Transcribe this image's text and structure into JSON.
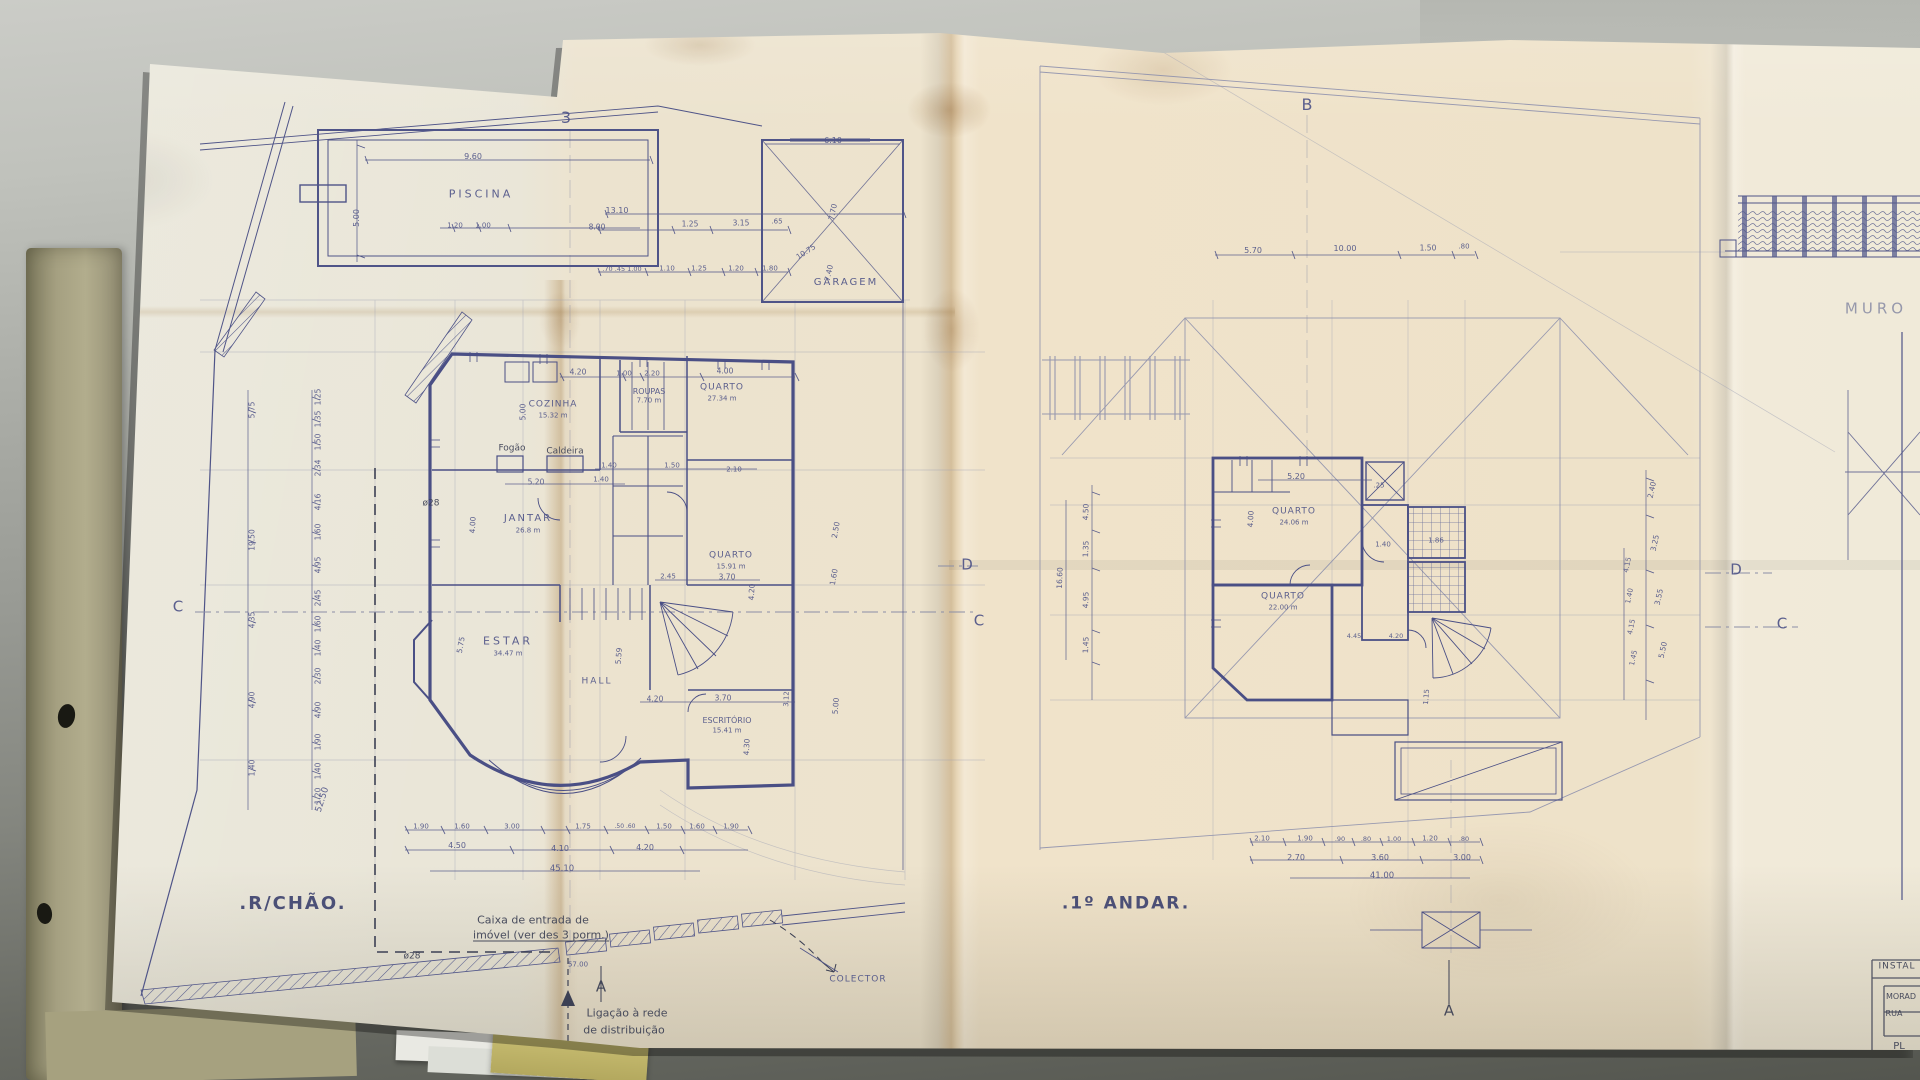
{
  "colors": {
    "ink": "#4f5488",
    "ink-strong": "#3d4273",
    "pencil": "#8f92a8",
    "dark": "#3c4054",
    "title-ink": "#3f4470",
    "paper": "#ece4d1",
    "desk-light": "#c8c9c4",
    "desk-dark": "#565851",
    "folder-olive": "#a7a281",
    "folder-yellow": "#c8bd72"
  },
  "document": {
    "plans": [
      {
        "title": ".R/CHÃO.",
        "rooms": [
          "PISCINA",
          "GARAGEM",
          "COZINHA",
          "ROUPAS",
          "QUARTO",
          "JANTAR",
          "QUARTO",
          "ESTAR",
          "HALL",
          "ESCRITÓRIO"
        ],
        "areas": [
          "15.32 m",
          "7.70 m",
          "27.34 m",
          "26.8 m",
          "15.91 m",
          "34.47 m",
          "15.41 m"
        ]
      },
      {
        "title": ".1º ANDAR.",
        "rooms": [
          "QUARTO",
          "QUARTO"
        ],
        "areas": [
          "24.06 m",
          "22.00 m"
        ]
      }
    ],
    "section_markers": [
      "3",
      "B",
      "C",
      "D",
      "A"
    ],
    "titleblock": [
      "INSTAL",
      "MORAD",
      "RUA",
      "PL"
    ]
  },
  "labels": {
    "markers": [
      {
        "n": "section-marker-3",
        "t": "3",
        "x": 566,
        "y": 118,
        "fs": 16,
        "c": "ink"
      },
      {
        "n": "section-marker-b",
        "t": "B",
        "x": 1307,
        "y": 105,
        "fs": 16,
        "c": "ink"
      },
      {
        "n": "section-marker-c-left",
        "t": "C",
        "x": 178,
        "y": 607,
        "fs": 15,
        "c": "ink"
      },
      {
        "n": "section-marker-d-mid",
        "t": "D",
        "x": 967,
        "y": 565,
        "fs": 15,
        "c": "ink"
      },
      {
        "n": "section-marker-c-mid",
        "t": "C",
        "x": 979,
        "y": 621,
        "fs": 15,
        "c": "ink"
      },
      {
        "n": "section-marker-d-right",
        "t": "D",
        "x": 1736,
        "y": 570,
        "fs": 15,
        "c": "ink"
      },
      {
        "n": "section-marker-c-right",
        "t": "C",
        "x": 1782,
        "y": 624,
        "fs": 15,
        "c": "ink"
      },
      {
        "n": "section-marker-a-left",
        "t": "A",
        "x": 601,
        "y": 987,
        "fs": 15,
        "c": "dark"
      },
      {
        "n": "section-marker-a-right",
        "t": "A",
        "x": 1449,
        "y": 1011,
        "fs": 15,
        "c": "dark"
      },
      {
        "n": "muro-label",
        "t": "MURO",
        "x": 1876,
        "y": 309,
        "fs": 15,
        "c": "pencil",
        "ls": 4
      }
    ],
    "ground_rooms": [
      {
        "n": "plan-title-ground",
        "t": ".R/CHÃO.",
        "x": 293,
        "y": 904,
        "fs": 18,
        "c": "title",
        "ls": 2
      },
      {
        "n": "room-piscina",
        "t": "PISCINA",
        "x": 481,
        "y": 194,
        "fs": 11,
        "c": "ink",
        "ls": 3
      },
      {
        "n": "room-garagem",
        "t": "GARAGEM",
        "x": 846,
        "y": 283,
        "fs": 10,
        "c": "ink",
        "ls": 2
      },
      {
        "n": "room-cozinha",
        "t": "COZINHA",
        "x": 553,
        "y": 405,
        "fs": 9,
        "c": "ink",
        "ls": 1
      },
      {
        "n": "room-cozinha-area",
        "t": "15.32 m",
        "x": 553,
        "y": 416,
        "fs": 7,
        "c": "ink"
      },
      {
        "n": "room-roupas",
        "t": "ROUPAS",
        "x": 649,
        "y": 392,
        "fs": 8,
        "c": "ink"
      },
      {
        "n": "room-roupas-area",
        "t": "7.70 m",
        "x": 649,
        "y": 401,
        "fs": 7,
        "c": "ink"
      },
      {
        "n": "room-quarto-1",
        "t": "QUARTO",
        "x": 722,
        "y": 388,
        "fs": 9,
        "c": "ink",
        "ls": 1
      },
      {
        "n": "room-quarto-1-area",
        "t": "27.34 m",
        "x": 722,
        "y": 399,
        "fs": 7,
        "c": "ink"
      },
      {
        "n": "room-jantar",
        "t": "JANTAR",
        "x": 528,
        "y": 519,
        "fs": 10,
        "c": "ink",
        "ls": 2
      },
      {
        "n": "room-jantar-area",
        "t": "26.8 m",
        "x": 528,
        "y": 531,
        "fs": 7,
        "c": "ink"
      },
      {
        "n": "room-quarto-2",
        "t": "QUARTO",
        "x": 731,
        "y": 556,
        "fs": 9,
        "c": "ink",
        "ls": 1
      },
      {
        "n": "room-quarto-2-area",
        "t": "15.91 m",
        "x": 731,
        "y": 567,
        "fs": 7,
        "c": "ink"
      },
      {
        "n": "room-estar",
        "t": "ESTAR",
        "x": 508,
        "y": 641,
        "fs": 11,
        "c": "ink",
        "ls": 3
      },
      {
        "n": "room-estar-area",
        "t": "34.47 m",
        "x": 508,
        "y": 654,
        "fs": 7,
        "c": "ink"
      },
      {
        "n": "room-hall",
        "t": "HALL",
        "x": 597,
        "y": 682,
        "fs": 9,
        "c": "ink",
        "ls": 2
      },
      {
        "n": "room-escritorio",
        "t": "ESCRITÓRIO",
        "x": 727,
        "y": 721,
        "fs": 8,
        "c": "ink"
      },
      {
        "n": "room-escritorio-area",
        "t": "15.41 m",
        "x": 727,
        "y": 731,
        "fs": 7,
        "c": "ink"
      },
      {
        "n": "fogao-label",
        "t": "Fogão",
        "x": 512,
        "y": 449,
        "fs": 9,
        "c": "dark"
      },
      {
        "n": "caldeira-label",
        "t": "Caldeira",
        "x": 565,
        "y": 452,
        "fs": 9,
        "c": "dark"
      },
      {
        "n": "diameter-28-upper",
        "t": "ø28",
        "x": 431,
        "y": 504,
        "fs": 9,
        "c": "dark"
      },
      {
        "n": "diameter-28-lower",
        "t": "ø28",
        "x": 412,
        "y": 957,
        "fs": 9,
        "c": "dark"
      }
    ],
    "ground_annotations": [
      {
        "n": "caixa-note-line1",
        "t": "Caixa de entrada de",
        "x": 533,
        "y": 920,
        "fs": 11,
        "c": "dark"
      },
      {
        "n": "caixa-note-line2",
        "t": "imóvel (ver des 3 porm.)",
        "x": 541,
        "y": 935,
        "fs": 11,
        "c": "dark",
        "u": true
      },
      {
        "n": "ligacao-note-line1",
        "t": "Ligação à rede",
        "x": 627,
        "y": 1013,
        "fs": 11,
        "c": "dark"
      },
      {
        "n": "ligacao-note-line2",
        "t": "de distribuição",
        "x": 624,
        "y": 1030,
        "fs": 11,
        "c": "dark"
      },
      {
        "n": "colector-label",
        "t": "COLECTOR",
        "x": 858,
        "y": 980,
        "fs": 9,
        "c": "ink",
        "ls": 1
      },
      {
        "n": "dim-57-00",
        "t": "57.00",
        "x": 578,
        "y": 965,
        "fs": 7,
        "c": "ink"
      }
    ],
    "ground_dims": [
      {
        "t": "9.60",
        "x": 473,
        "y": 157
      },
      {
        "t": "5.00",
        "x": 357,
        "y": 218,
        "r": -90
      },
      {
        "t": "1.20",
        "x": 455,
        "y": 226,
        "fs": 7
      },
      {
        "t": "1.00",
        "x": 483,
        "y": 226,
        "fs": 7
      },
      {
        "t": "13.10",
        "x": 617,
        "y": 211
      },
      {
        "t": "8.00",
        "x": 597,
        "y": 227,
        "fs": 7.5
      },
      {
        "t": "1.25",
        "x": 690,
        "y": 224,
        "fs": 7.5
      },
      {
        "t": "3.15",
        "x": 741,
        "y": 223,
        "fs": 7.5
      },
      {
        "t": ".65",
        "x": 777,
        "y": 222,
        "fs": 7
      },
      {
        "t": "10.75",
        "x": 806,
        "y": 252,
        "fs": 7.5,
        "r": -33
      },
      {
        "t": "7.70",
        "x": 833,
        "y": 212,
        "fs": 7.5,
        "r": -78
      },
      {
        "t": "7.40",
        "x": 829,
        "y": 273,
        "fs": 7.5,
        "r": -78
      },
      {
        "t": ".70 .45 1.00",
        "x": 622,
        "y": 269,
        "fs": 6.5
      },
      {
        "t": "1.10",
        "x": 667,
        "y": 269,
        "fs": 7
      },
      {
        "t": "1.25",
        "x": 699,
        "y": 269,
        "fs": 7
      },
      {
        "t": "1.20",
        "x": 736,
        "y": 269,
        "fs": 7
      },
      {
        "t": "1.80",
        "x": 770,
        "y": 269,
        "fs": 7
      },
      {
        "t": "6.10",
        "x": 833,
        "y": 141
      },
      {
        "t": "4.20",
        "x": 578,
        "y": 372,
        "fs": 7.5
      },
      {
        "t": "1.00",
        "x": 624,
        "y": 374,
        "fs": 7
      },
      {
        "t": "2.20",
        "x": 652,
        "y": 374,
        "fs": 7
      },
      {
        "t": "4.00",
        "x": 725,
        "y": 371,
        "fs": 7.5
      },
      {
        "t": "5.00",
        "x": 523,
        "y": 412,
        "fs": 7.5,
        "r": -90
      },
      {
        "t": "1.40",
        "x": 609,
        "y": 466,
        "fs": 7
      },
      {
        "t": "1.50",
        "x": 672,
        "y": 466,
        "fs": 7
      },
      {
        "t": "2.10",
        "x": 734,
        "y": 470,
        "fs": 7
      },
      {
        "t": "5.20",
        "x": 536,
        "y": 482,
        "fs": 7.5
      },
      {
        "t": "1.40",
        "x": 601,
        "y": 480,
        "fs": 7
      },
      {
        "t": "4.00",
        "x": 473,
        "y": 525,
        "fs": 7.5,
        "r": -87
      },
      {
        "t": "2.45",
        "x": 668,
        "y": 577,
        "fs": 7
      },
      {
        "t": "3.70",
        "x": 727,
        "y": 577,
        "fs": 7.5
      },
      {
        "t": "4.20",
        "x": 752,
        "y": 592,
        "fs": 7.5,
        "r": -87
      },
      {
        "t": "2.50",
        "x": 836,
        "y": 530,
        "fs": 7.5,
        "r": -80
      },
      {
        "t": "1.60",
        "x": 834,
        "y": 577,
        "fs": 7.5,
        "r": -80
      },
      {
        "t": "5.75",
        "x": 461,
        "y": 645,
        "fs": 7.5,
        "r": -80
      },
      {
        "t": "5.59",
        "x": 619,
        "y": 656,
        "fs": 7.5,
        "r": -85
      },
      {
        "t": "4.20",
        "x": 655,
        "y": 699,
        "fs": 7.5
      },
      {
        "t": "3.70",
        "x": 723,
        "y": 698,
        "fs": 7.5
      },
      {
        "t": "4.30",
        "x": 747,
        "y": 747,
        "fs": 7.5,
        "r": -87
      },
      {
        "t": "3.12",
        "x": 787,
        "y": 699,
        "fs": 7,
        "r": -87
      },
      {
        "t": "5.00",
        "x": 836,
        "y": 706,
        "fs": 7.5,
        "r": -85
      },
      {
        "t": "1.25",
        "x": 318,
        "y": 397,
        "fs": 7.5,
        "r": -90
      },
      {
        "t": "1.35",
        "x": 318,
        "y": 419,
        "fs": 7.5,
        "r": -90
      },
      {
        "t": "1.50",
        "x": 318,
        "y": 442,
        "fs": 7.5,
        "r": -90
      },
      {
        "t": "2.34",
        "x": 318,
        "y": 468,
        "fs": 7.5,
        "r": -90
      },
      {
        "t": "4.16",
        "x": 318,
        "y": 502,
        "fs": 7.5,
        "r": -90
      },
      {
        "t": "1.60",
        "x": 318,
        "y": 532,
        "fs": 7.5,
        "r": -90
      },
      {
        "t": "4.95",
        "x": 318,
        "y": 565,
        "fs": 7.5,
        "r": -90
      },
      {
        "t": "2.45",
        "x": 318,
        "y": 598,
        "fs": 7.5,
        "r": -90
      },
      {
        "t": "1.60",
        "x": 318,
        "y": 624,
        "fs": 7.5,
        "r": -90
      },
      {
        "t": "1.40",
        "x": 318,
        "y": 648,
        "fs": 7.5,
        "r": -90
      },
      {
        "t": "2.30",
        "x": 318,
        "y": 676,
        "fs": 7.5,
        "r": -90
      },
      {
        "t": "4.90",
        "x": 318,
        "y": 710,
        "fs": 7.5,
        "r": -90
      },
      {
        "t": "1.90",
        "x": 318,
        "y": 742,
        "fs": 7.5,
        "r": -90
      },
      {
        "t": "1.40",
        "x": 318,
        "y": 771,
        "fs": 7.5,
        "r": -90
      },
      {
        "t": "1.20",
        "x": 318,
        "y": 796,
        "fs": 7.5,
        "r": -90
      },
      {
        "t": "5.75",
        "x": 252,
        "y": 410,
        "fs": 7.5,
        "r": -90
      },
      {
        "t": "19.50",
        "x": 252,
        "y": 540,
        "fs": 7.5,
        "r": -90
      },
      {
        "t": "4.35",
        "x": 252,
        "y": 620,
        "fs": 7.5,
        "r": -90
      },
      {
        "t": "4.90",
        "x": 252,
        "y": 700,
        "fs": 7.5,
        "r": -90
      },
      {
        "t": "1.40",
        "x": 252,
        "y": 768,
        "fs": 7.5,
        "r": -90
      },
      {
        "t": "52.50",
        "x": 323,
        "y": 800,
        "fs": 9,
        "r": -72
      },
      {
        "t": "1.90",
        "x": 421,
        "y": 827,
        "fs": 7
      },
      {
        "t": "1.60",
        "x": 462,
        "y": 827,
        "fs": 7
      },
      {
        "t": "3.00",
        "x": 512,
        "y": 827,
        "fs": 7
      },
      {
        "t": "1.75",
        "x": 583,
        "y": 827,
        "fs": 7
      },
      {
        "t": ".50 .60",
        "x": 625,
        "y": 827,
        "fs": 6
      },
      {
        "t": "1.50",
        "x": 664,
        "y": 827,
        "fs": 7
      },
      {
        "t": "1.60",
        "x": 697,
        "y": 827,
        "fs": 7
      },
      {
        "t": "1.90",
        "x": 731,
        "y": 827,
        "fs": 7
      },
      {
        "t": "4.50",
        "x": 457,
        "y": 846
      },
      {
        "t": "4.10",
        "x": 560,
        "y": 849
      },
      {
        "t": "4.20",
        "x": 645,
        "y": 848
      },
      {
        "t": "45.10",
        "x": 562,
        "y": 869,
        "fs": 8.5
      }
    ],
    "first_rooms": [
      {
        "n": "plan-title-first",
        "t": ".1º ANDAR.",
        "x": 1126,
        "y": 904,
        "fs": 17,
        "c": "title",
        "ls": 2
      },
      {
        "n": "room-quarto-3",
        "t": "QUARTO",
        "x": 1294,
        "y": 512,
        "fs": 9,
        "c": "ink",
        "ls": 1
      },
      {
        "n": "room-quarto-3-area",
        "t": "24.06 m",
        "x": 1294,
        "y": 523,
        "fs": 7,
        "c": "ink"
      },
      {
        "n": "room-quarto-4",
        "t": "QUARTO",
        "x": 1283,
        "y": 597,
        "fs": 9,
        "c": "ink",
        "ls": 1
      },
      {
        "n": "room-quarto-4-area",
        "t": "22.00 m",
        "x": 1283,
        "y": 608,
        "fs": 7,
        "c": "ink"
      }
    ],
    "first_dims": [
      {
        "t": "5.70",
        "x": 1253,
        "y": 251
      },
      {
        "t": "10.00",
        "x": 1345,
        "y": 249
      },
      {
        "t": "1.50",
        "x": 1428,
        "y": 248,
        "fs": 7.5
      },
      {
        "t": ".80",
        "x": 1464,
        "y": 247,
        "fs": 7
      },
      {
        "t": "5.20",
        "x": 1296,
        "y": 477
      },
      {
        "t": ".25",
        "x": 1379,
        "y": 486,
        "fs": 7
      },
      {
        "t": "4.00",
        "x": 1251,
        "y": 519,
        "fs": 7.5,
        "r": -87
      },
      {
        "t": "1.40",
        "x": 1383,
        "y": 545,
        "fs": 7
      },
      {
        "t": "1.86",
        "x": 1436,
        "y": 541,
        "fs": 7
      },
      {
        "t": "4.45",
        "x": 1354,
        "y": 636,
        "fs": 6.5
      },
      {
        "t": "4.20",
        "x": 1396,
        "y": 636,
        "fs": 6.5
      },
      {
        "t": "1.15",
        "x": 1427,
        "y": 697,
        "fs": 7,
        "r": -85
      },
      {
        "t": "4.50",
        "x": 1086,
        "y": 512,
        "fs": 7.5,
        "r": -88
      },
      {
        "t": "1.35",
        "x": 1086,
        "y": 549,
        "fs": 7.5,
        "r": -88
      },
      {
        "t": "4.95",
        "x": 1086,
        "y": 600,
        "fs": 7.5,
        "r": -88
      },
      {
        "t": "1.45",
        "x": 1086,
        "y": 645,
        "fs": 7.5,
        "r": -88
      },
      {
        "t": "16.60",
        "x": 1060,
        "y": 578,
        "fs": 7.5,
        "r": -88
      },
      {
        "t": "2.40",
        "x": 1652,
        "y": 490,
        "fs": 7.5,
        "r": -78
      },
      {
        "t": "3.25",
        "x": 1655,
        "y": 543,
        "fs": 7.5,
        "r": -78
      },
      {
        "t": "3.55",
        "x": 1659,
        "y": 597,
        "fs": 7.5,
        "r": -78
      },
      {
        "t": "5.50",
        "x": 1663,
        "y": 650,
        "fs": 7.5,
        "r": -78
      },
      {
        "t": "4.15",
        "x": 1628,
        "y": 565,
        "fs": 7,
        "r": -78
      },
      {
        "t": "1.40",
        "x": 1630,
        "y": 596,
        "fs": 7,
        "r": -78
      },
      {
        "t": "4.15",
        "x": 1632,
        "y": 627,
        "fs": 7,
        "r": -78
      },
      {
        "t": "1.45",
        "x": 1634,
        "y": 658,
        "fs": 7,
        "r": -78
      },
      {
        "t": "2.10",
        "x": 1262,
        "y": 839,
        "fs": 7
      },
      {
        "t": "1.90",
        "x": 1305,
        "y": 839,
        "fs": 7
      },
      {
        "t": ".90",
        "x": 1340,
        "y": 839,
        "fs": 6.5
      },
      {
        "t": ".80",
        "x": 1366,
        "y": 839,
        "fs": 6.5
      },
      {
        "t": "1.00",
        "x": 1394,
        "y": 839,
        "fs": 6.5
      },
      {
        "t": "1.20",
        "x": 1430,
        "y": 839,
        "fs": 7
      },
      {
        "t": ".80",
        "x": 1464,
        "y": 839,
        "fs": 6.5
      },
      {
        "t": "2.70",
        "x": 1296,
        "y": 858
      },
      {
        "t": "3.60",
        "x": 1380,
        "y": 858
      },
      {
        "t": "3.00",
        "x": 1462,
        "y": 858
      },
      {
        "t": "41.00",
        "x": 1382,
        "y": 876,
        "fs": 8.5
      }
    ],
    "titleblock": [
      {
        "n": "titleblock-header",
        "t": "INSTAL",
        "x": 1897,
        "y": 967,
        "fs": 9,
        "c": "dark",
        "ls": 1
      },
      {
        "n": "titleblock-line1",
        "t": "MORAD",
        "x": 1901,
        "y": 997,
        "fs": 8,
        "c": "dark"
      },
      {
        "n": "titleblock-line2",
        "t": "RUA",
        "x": 1894,
        "y": 1014,
        "fs": 8,
        "c": "dark"
      },
      {
        "n": "titleblock-line3",
        "t": "PL",
        "x": 1899,
        "y": 1047,
        "fs": 10,
        "c": "dark"
      }
    ]
  }
}
